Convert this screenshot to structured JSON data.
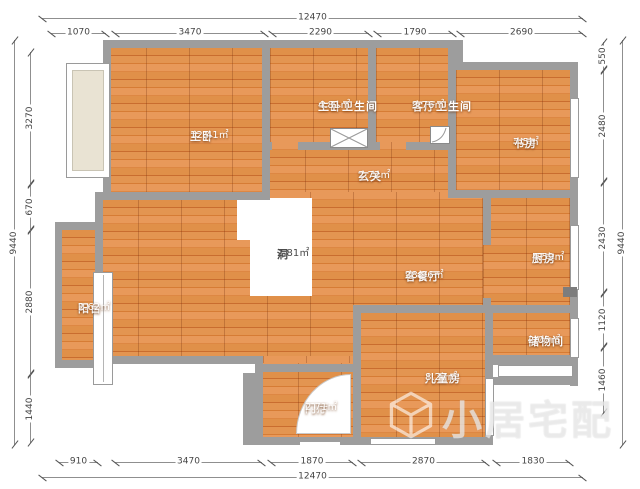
{
  "canvas": {
    "bg": "#ffffff"
  },
  "colors": {
    "wall": "#9d9d9d",
    "floor_base": "#d97f38",
    "dim_text": "#444444",
    "room_text": "#ffffff",
    "void_text": "#4a4a4a"
  },
  "rooms": {
    "master_bedroom": {
      "name": "主卧",
      "area": "12.41㎡"
    },
    "master_bathroom": {
      "name": "主卧卫生间",
      "area": "4.81㎡"
    },
    "living_bathroom": {
      "name": "客厅卫生间",
      "area": "3.76㎡"
    },
    "study": {
      "name": "书房",
      "area": "7.5㎡"
    },
    "entry_hall": {
      "name": "玄关",
      "area": "2.72㎡"
    },
    "void": {
      "name": "洞",
      "area": "2.81㎡"
    },
    "living_dining": {
      "name": "客餐厅",
      "area": "28.96㎡"
    },
    "kitchen": {
      "name": "厨房",
      "area": "4.59㎡"
    },
    "balcony": {
      "name": "阳台",
      "area": "2.62㎡"
    },
    "storage": {
      "name": "储物间",
      "area": "2.05㎡"
    },
    "kids_room": {
      "name": "儿童房",
      "area": "8.27㎡"
    },
    "foyer": {
      "name": "门厅",
      "area": "2.71㎡"
    }
  },
  "dimensions": {
    "top": {
      "total": "12470",
      "segments": [
        "1070",
        "3470",
        "2290",
        "1790",
        "2690"
      ]
    },
    "bottom": {
      "total": "12470",
      "segments": [
        "910",
        "3470",
        "1870",
        "2870",
        "1830"
      ]
    },
    "left": {
      "total": "9440",
      "segments": [
        "3270",
        "670",
        "2880",
        "1440"
      ]
    },
    "right": {
      "total": "9440",
      "segments": [
        "550",
        "2480",
        "2430",
        "1120",
        "1460"
      ]
    }
  },
  "watermark": {
    "text": "小居宅配"
  }
}
